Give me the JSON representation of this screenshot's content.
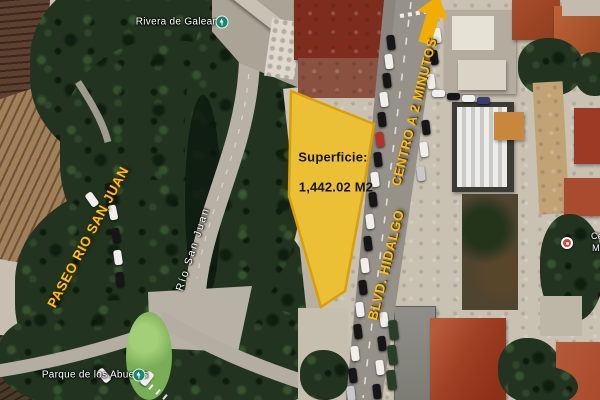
{
  "annotations": {
    "parcel": {
      "superficie_label": "Superficie:",
      "superficie_value": "1,442.02 M2"
    },
    "road_labels": {
      "paseo_rio_san_juan": "PASEO RIO SAN JUAN",
      "blvd_hidalgo": "BLVD. HIDALGO",
      "centro_a_2_minutos": "CENTRO A 2 MINUTOS"
    }
  },
  "map_labels": {
    "rivera_de_galeana": "Rivera de Galeana",
    "rio_san_juan": "Río San Juan",
    "parque_de_los_abuelos": "Parque de los Abuelos",
    "edge_poi_partial_line1": "Cé",
    "edge_poi_partial_line2": "M"
  },
  "icons": {
    "park_pin_rivera": "green-park-pin",
    "park_pin_abuelos": "green-park-pin",
    "poi_pin": "red-poi-pin",
    "direction_arrow": "yellow-up-arrow"
  },
  "colors": {
    "parcel_fill": "#F5C31E",
    "parcel_border": "#DD9E00",
    "parcel_ground": "#C9B28C",
    "road_label_yellow": "#FFBF0D",
    "arrow_yellow": "#F2AE00",
    "map_label_white": "#FFFFFF",
    "park_pin_green": "#138A6B",
    "poi_pin_red": "#E04038"
  }
}
